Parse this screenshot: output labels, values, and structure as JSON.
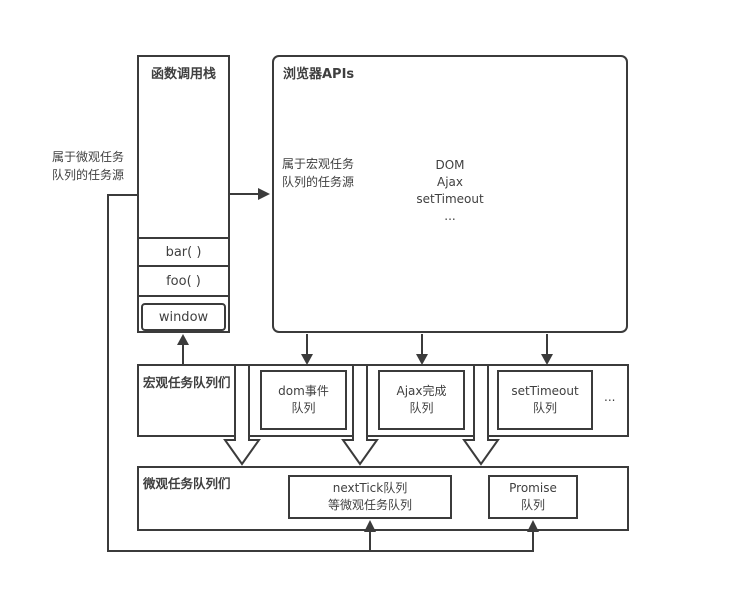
{
  "colors": {
    "line": "#3b3b3b",
    "text": "#3f3f3f",
    "background": "#ffffff"
  },
  "left_note": {
    "line1": "属于微观任务",
    "line2": "队列的任务源"
  },
  "call_stack": {
    "title": "函数调用栈",
    "frames": [
      "bar( )",
      "foo( )"
    ],
    "base": "window"
  },
  "browser": {
    "title": "浏览器APIs",
    "note": {
      "line1": "属于宏观任务",
      "line2": "队列的任务源"
    },
    "apis": [
      "DOM",
      "Ajax",
      "setTimeout",
      "..."
    ]
  },
  "macro": {
    "title": "宏观任务队列们",
    "queues": [
      {
        "line1": "dom事件",
        "line2": "队列"
      },
      {
        "line1": "Ajax完成",
        "line2": "队列"
      },
      {
        "line1": "setTimeout",
        "line2": "队列"
      }
    ],
    "ellipsis": "..."
  },
  "micro": {
    "title": "微观任务队列们",
    "queues": [
      {
        "line1": "nextTick队列",
        "line2": "等微观任务队列"
      },
      {
        "line1": "Promise",
        "line2": "队列"
      }
    ]
  }
}
